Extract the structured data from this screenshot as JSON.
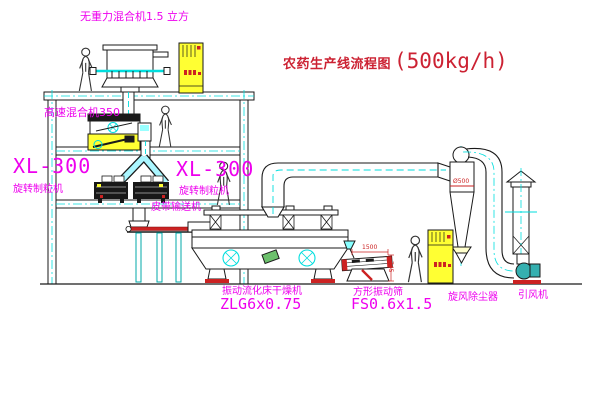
{
  "title": {
    "text": "农药生产线流程图",
    "capacity": "(500kg/h)"
  },
  "labels": {
    "gravity_mixer": "无重力混合机1.5 立方",
    "high_speed_mixer": "高速混合机350",
    "granulator_left_model": "XL-300",
    "granulator_left_name": "旋转制粒机",
    "granulator_right_model": "XL-300",
    "granulator_right_name": "旋转制粒机",
    "belt_conveyor": "皮带输送机",
    "dryer_name": "振动流化床干燥机",
    "dryer_model": "ZLG6x0.75",
    "screen_name": "方形振动筛",
    "screen_model": "FS0.6x1.5",
    "cyclone_name": "旋风除尘器",
    "fan_name": "引风机"
  },
  "dimensions": {
    "cyclone_diameter": "Ø500",
    "screen_length": "1500",
    "screen_height": "745"
  },
  "colors": {
    "label_magenta": "#ee00ee",
    "title_red": "#cc2233",
    "dimension_red": "#cc2222",
    "centerline_cyan": "#00dede",
    "cabinet_yellow": "#ffff33",
    "belt_red": "#cc2222",
    "line_black": "#1a1a1a"
  }
}
